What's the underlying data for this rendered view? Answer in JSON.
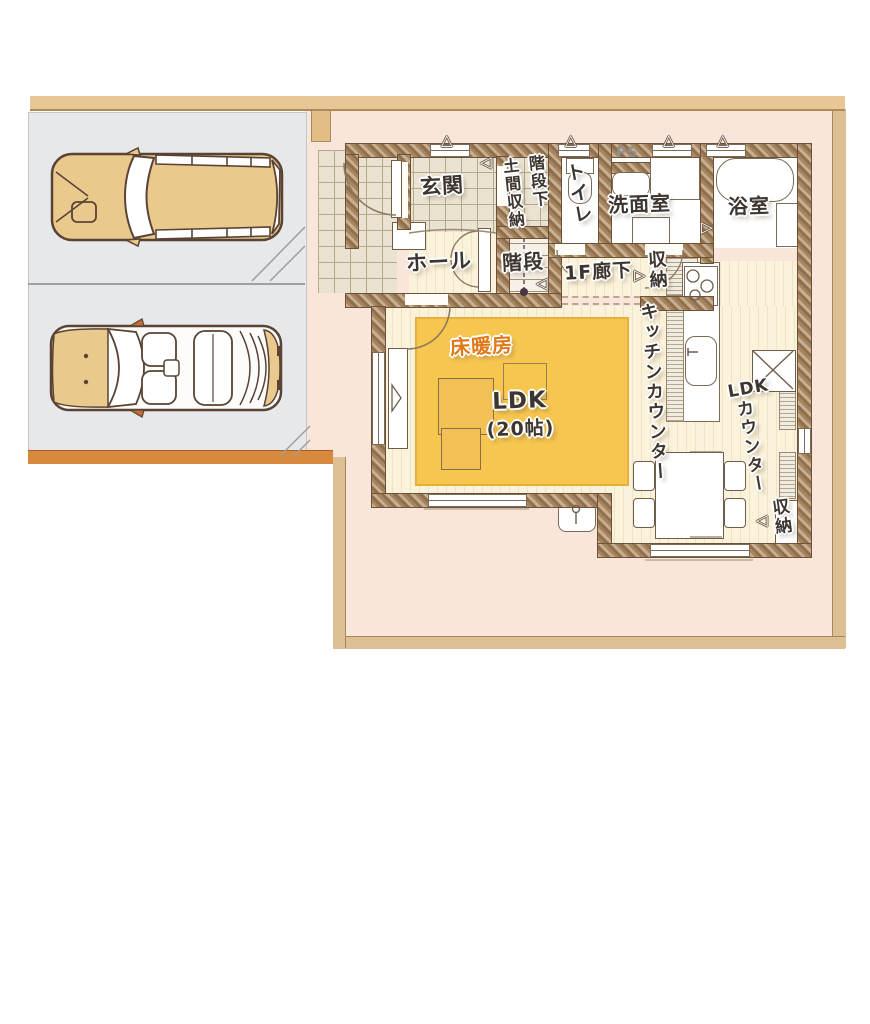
{
  "title": "1F floor plan with parking",
  "labels": {
    "genkan": "玄関",
    "under_stairs": "階段下",
    "doma_storage": "土間収納",
    "toilet": "トイレ",
    "ps": "PS",
    "washroom": "洗面室",
    "bathroom": "浴室",
    "hall": "ホール",
    "stairs": "階段",
    "corridor_1f": "1F廊下",
    "storage_corridor": "収納",
    "kitchen_counter": "キッチンカウンター",
    "floor_heating": "床暖房",
    "ldk_name": "LDK",
    "ldk_size": "(20帖)",
    "ldk_counter_latin": "LDK",
    "ldk_counter_kana": "カウンター",
    "storage_br": "収納"
  },
  "icons": {
    "window_marker": "△",
    "door_marker_left": "◁",
    "door_marker_right": "▷"
  },
  "colors": {
    "wall": "#a5845f",
    "floor_heating": "#f7c64f",
    "heating_label": "#e07818",
    "yard": "#f9e5da",
    "frame": "#dcc094",
    "parking": "#e7e8ea",
    "curb": "#d8893e",
    "car_body_tan": "#e9c98c",
    "wood_floor": "#faf2da",
    "tile_floor": "#eae3d1"
  }
}
